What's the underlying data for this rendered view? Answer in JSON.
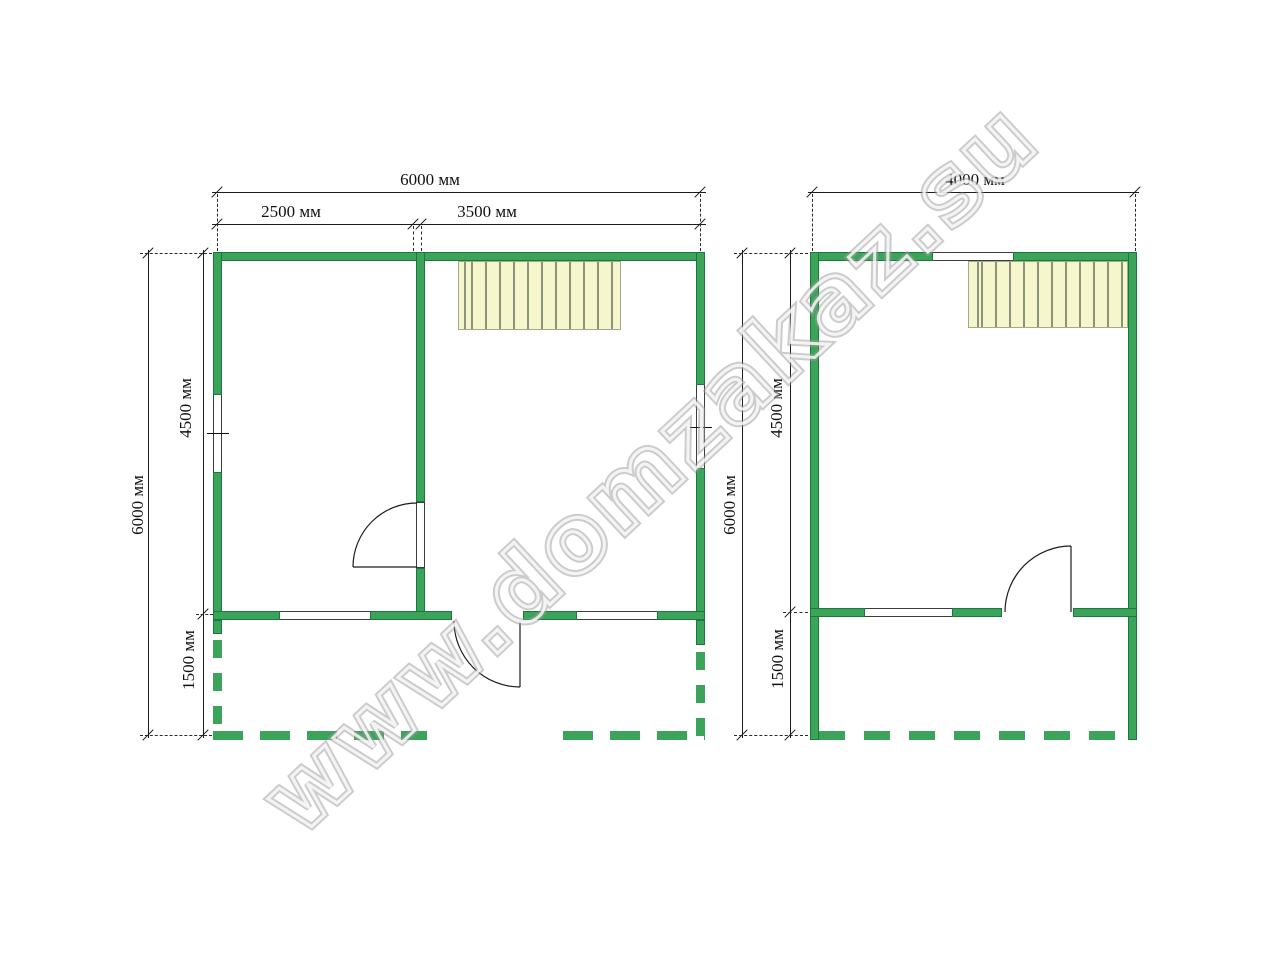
{
  "watermark": {
    "text": "www.domzakaz.su",
    "color": "#9b9b9b"
  },
  "colors": {
    "wall_green": "#3BA45A",
    "wall_outline": "#1A7A3C",
    "stairs_fill": "#F5F6CC",
    "stairs_tread_line": "#8D927B",
    "dimension_line": "#1c1c1c"
  },
  "plan_left": {
    "name": "first-floor-plan",
    "top_total": "6000 мм",
    "top_left_room": "2500 мм",
    "top_right_room": "3500 мм",
    "side_total": "6000 мм",
    "side_main": "4500 мм",
    "side_terrace": "1500 мм"
  },
  "plan_right": {
    "name": "second-floor-plan",
    "top_total": "4000 мм",
    "side_total": "6000 мм",
    "side_main": "4500 мм",
    "side_porch": "1500 мм"
  }
}
